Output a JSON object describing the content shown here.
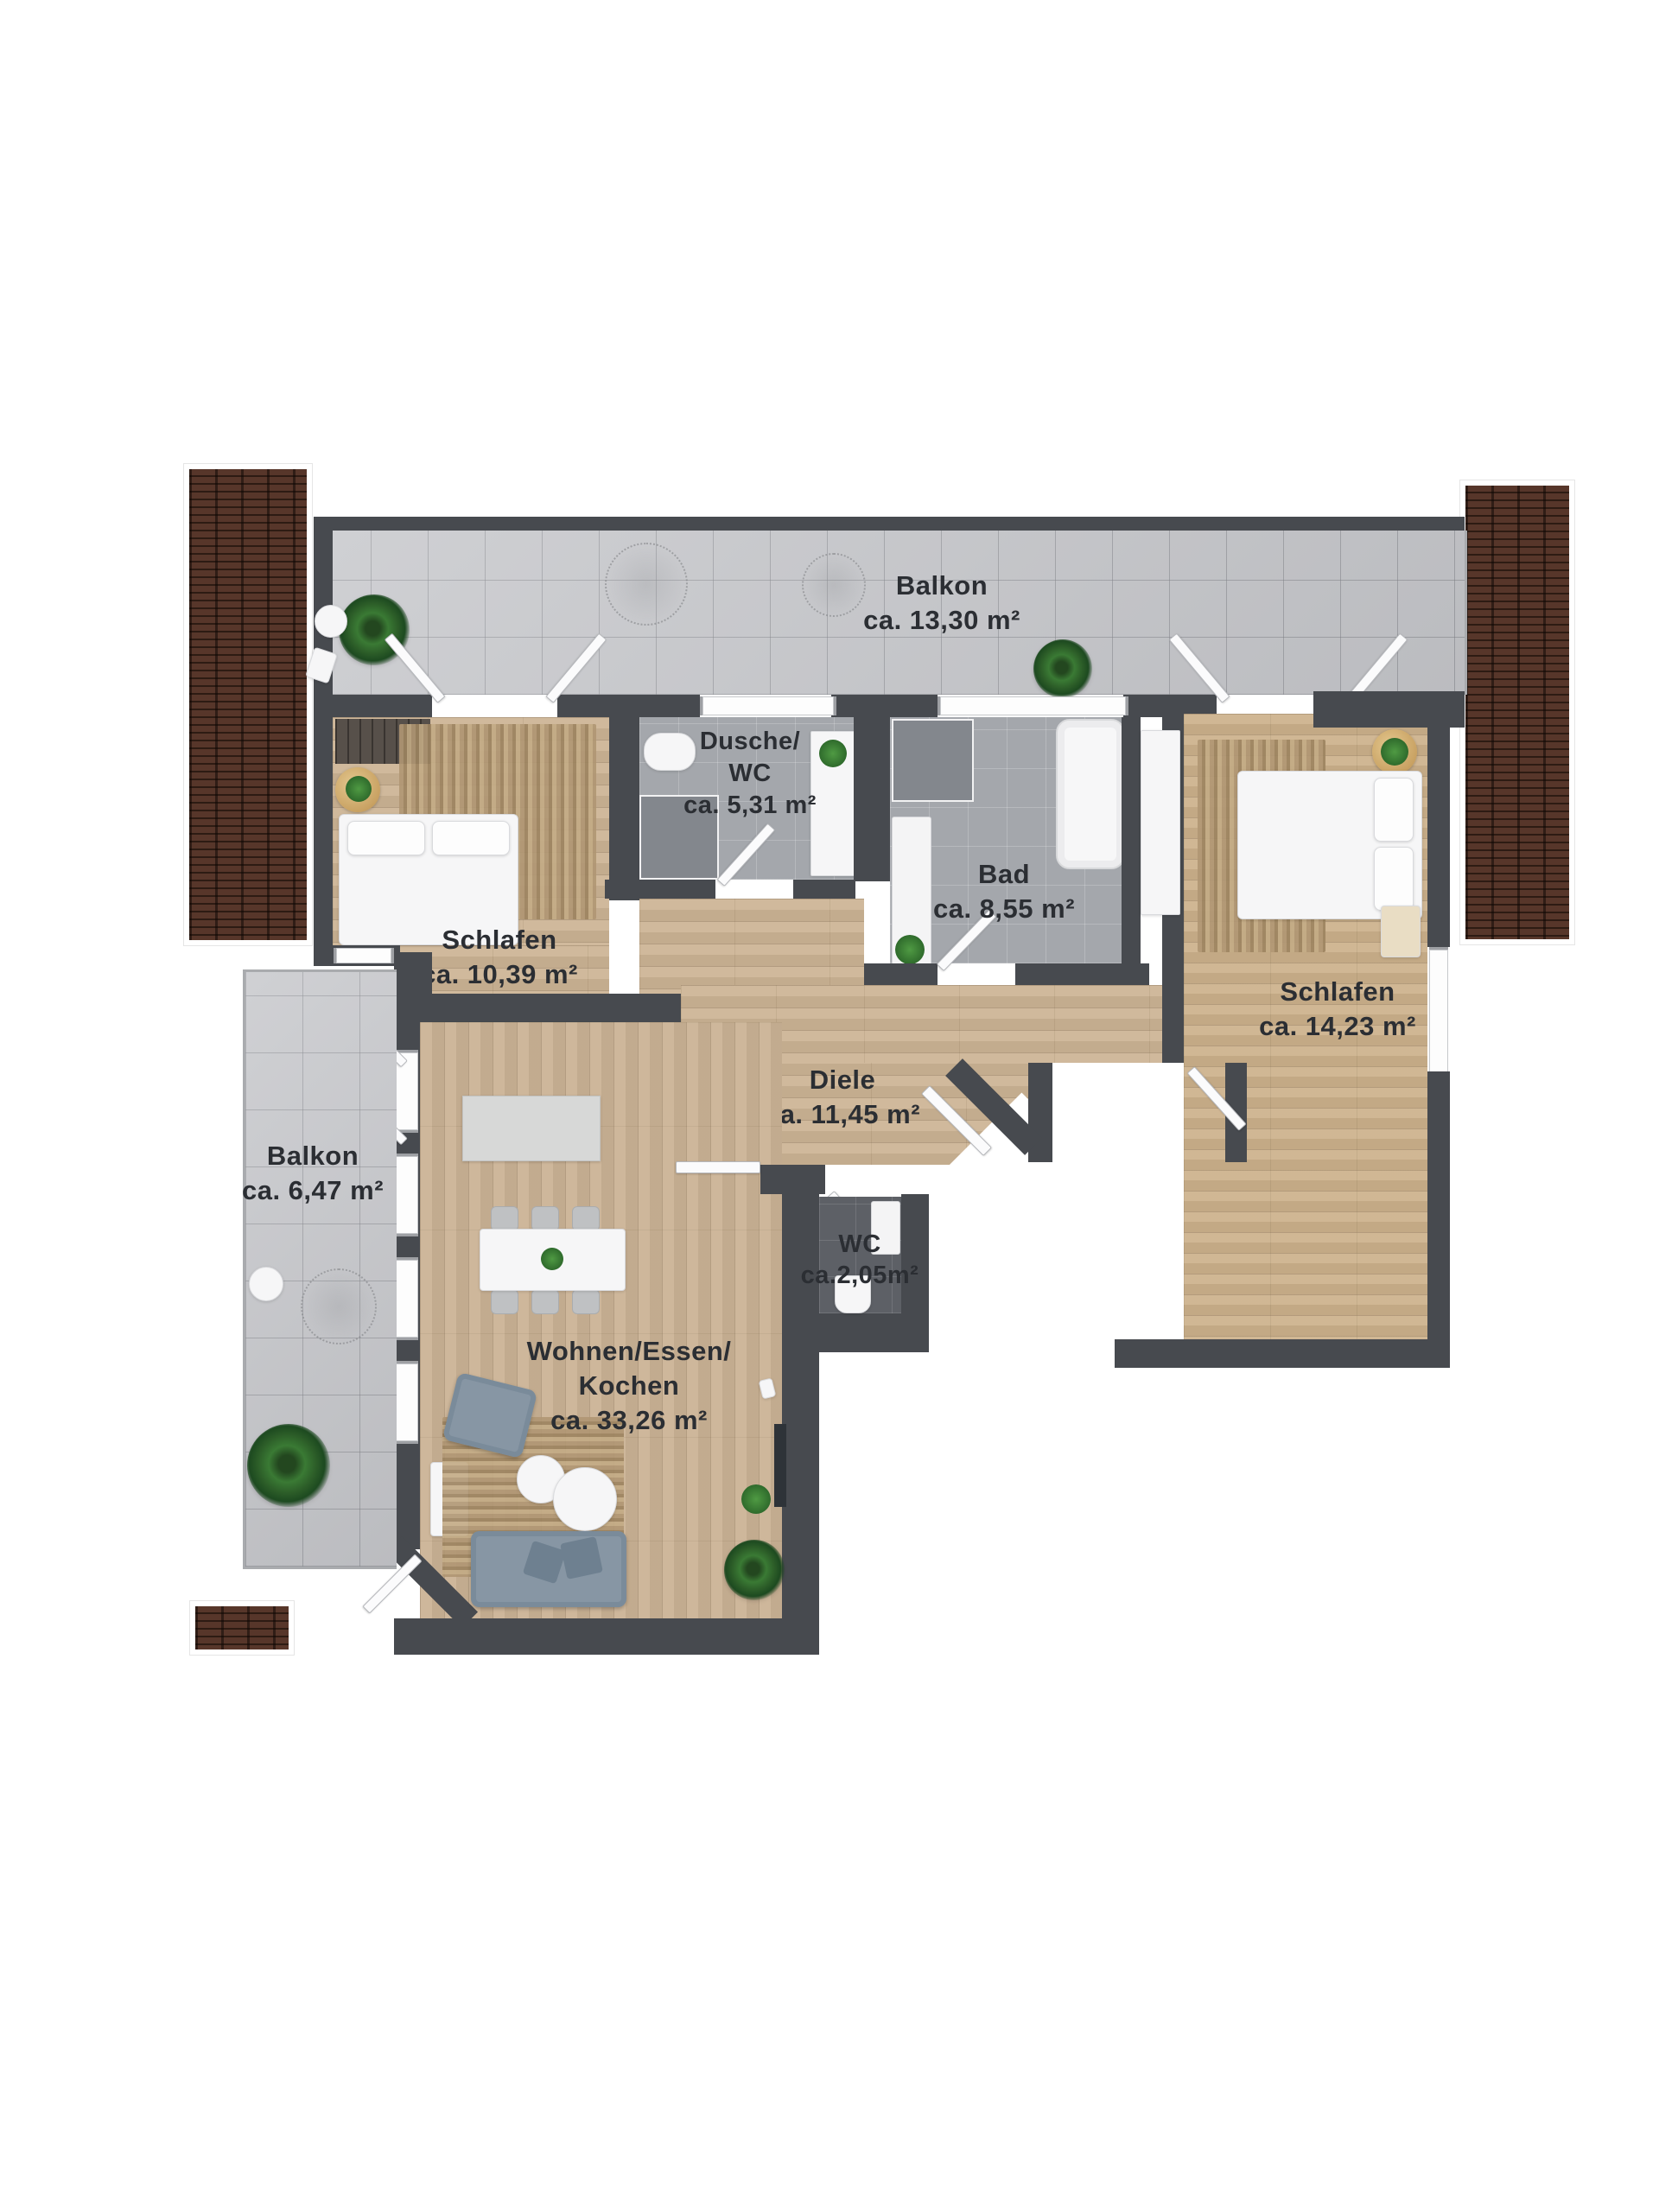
{
  "rooms": {
    "balkon_top": {
      "name": "Balkon",
      "area": "ca. 13,30 m²"
    },
    "schlafen_left": {
      "name": "Schlafen",
      "area": "ca. 10,39 m²"
    },
    "dusche_wc": {
      "line1": "Dusche/",
      "line2": "WC",
      "area": "ca. 5,31 m²"
    },
    "bad": {
      "name": "Bad",
      "area": "ca. 8,55 m²"
    },
    "schlafen_right": {
      "name": "Schlafen",
      "area": "ca. 14,23 m²"
    },
    "diele": {
      "name": "Diele",
      "area": "ca. 11,45 m²"
    },
    "balkon_left": {
      "name": "Balkon",
      "area": "ca. 6,47 m²"
    },
    "wc": {
      "name": "WC",
      "area": "ca.2,05m²"
    },
    "wohnen": {
      "line1": "Wohnen/Essen/",
      "line2": "Kochen",
      "area": "ca. 33,26 m²"
    }
  },
  "colors": {
    "wall": "#474a4f",
    "wood_floor": "#ccb494",
    "balcony_tile": "#c5c6ca",
    "bath_tile": "#a4a7ac",
    "wc_tile": "#5d6066",
    "roof_brick": "#43291e",
    "label_text": "#2b2e33",
    "sofa": "#8796a4",
    "plant": "#2c5d28"
  }
}
